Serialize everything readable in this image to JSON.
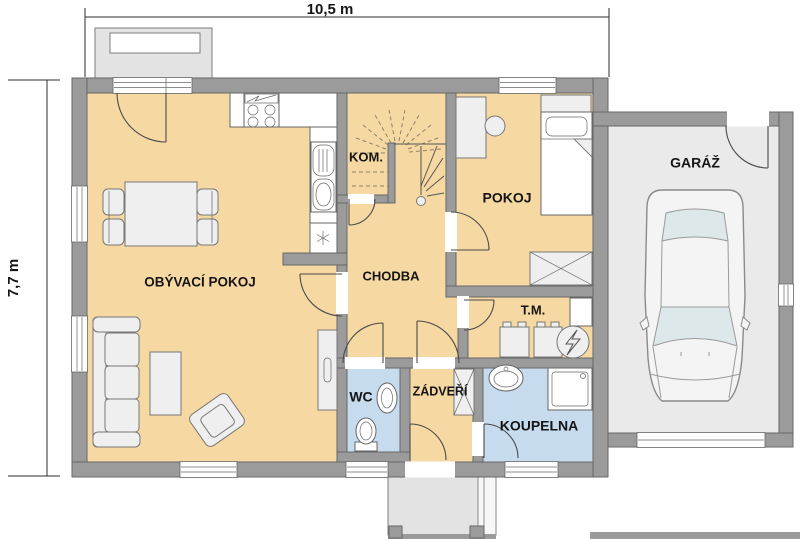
{
  "plan": {
    "dimensions": {
      "width": "10,5 m",
      "height": "7,7 m"
    },
    "rooms": {
      "living": "OBÝVACÍ POKOJ",
      "pantry": "KOM.",
      "hall": "CHODBA",
      "bedroom": "POKOJ",
      "tech": "T.M.",
      "wc": "WC",
      "vestibule": "ZÁDVEŘÍ",
      "bathroom": "KOUPELNA",
      "garage": "GARÁŽ"
    },
    "colors": {
      "wall": "#9b9b9b",
      "wallline": "#676767",
      "floor": "#f6d8a2",
      "wet": "#c7dbee",
      "garage": "#eaeaea",
      "furn": "#efefef",
      "line": "#4a4a4a",
      "ext": "#e3e3e3",
      "dash": "#8f8268",
      "text": "#151515"
    }
  }
}
